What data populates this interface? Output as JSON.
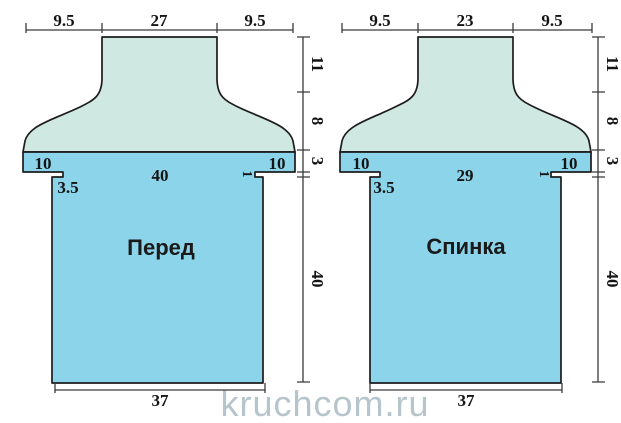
{
  "watermark": "kruchcom.ru",
  "colors": {
    "yoke_fill": "#cfe8e1",
    "body_fill": "#8cd4e9",
    "outline": "#1c1c1c",
    "dimension_line": "#3a3a3a",
    "number_text": "#141414",
    "watermark_text": "#b3c2ca"
  },
  "pieces": [
    {
      "label": "Перед",
      "top_widths": [
        "9.5",
        "27",
        "9.5"
      ],
      "band_widths": [
        "10",
        "40",
        "10"
      ],
      "armhole_inset": "3.5",
      "shoulder_step": "1",
      "bottom_width": "37",
      "side_heights": [
        "11",
        "8",
        "3",
        "40"
      ]
    },
    {
      "label": "Спинка",
      "top_widths": [
        "9.5",
        "23",
        "9.5"
      ],
      "band_widths": [
        "10",
        "29",
        "10"
      ],
      "armhole_inset": "3.5",
      "shoulder_step": "1",
      "bottom_width": "37",
      "side_heights": [
        "11",
        "8",
        "3",
        "40"
      ]
    }
  ]
}
